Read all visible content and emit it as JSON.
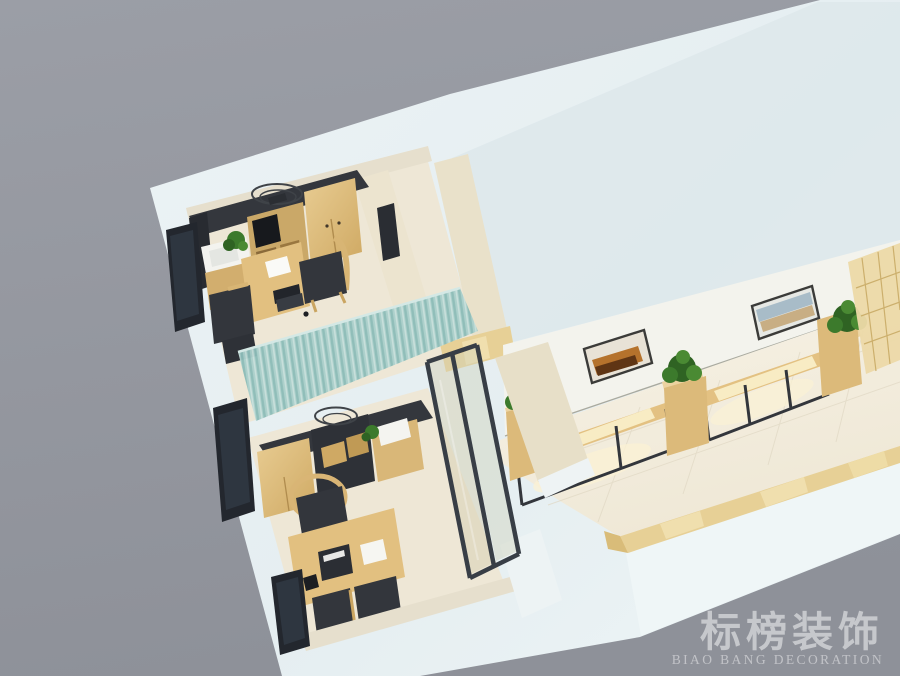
{
  "watermark": {
    "brand_cn": "标榜装饰",
    "brand_en": "BIAO BANG DECORATION"
  },
  "scene": {
    "type": "3d-interior-rendering",
    "view": "axonometric-dollhouse-cutaway",
    "background_color": "#989ba3",
    "palette": {
      "outer_wall": "#e9f1f3",
      "outer_wall_shade": "#dde8eb",
      "interior_wall_cream": "#e9e1ca",
      "office_floor": "#efe8d8",
      "hallway_floor": "#f4efe2",
      "wood": "#ddbb7b",
      "wood_light": "#ecd3a0",
      "dark_cabinet": "#34373d",
      "window_dark": "#23272e",
      "curtain_teal": "#a7cdc9",
      "glass_frame": "#3a4048",
      "tile_border_tan": "#e7d096",
      "plant_green": "#2f6323",
      "bench_glow": "#f8ecc4",
      "watermark_text": "#ced3da"
    },
    "rooms": [
      {
        "name": "office-1",
        "furniture": [
          "ceiling-fan",
          "dark-storage-counter",
          "tv-shelf-unit",
          "wood-wardrobe",
          "wash-basin-cabinet",
          "potted-plant",
          "work-desk",
          "paper-sheet",
          "laptop",
          "office-chair",
          "guest-seat",
          "guest-seat-2"
        ]
      },
      {
        "name": "office-2",
        "furniture": [
          "ceiling-lamp",
          "dark-storage-counter",
          "cubby-shelf",
          "wood-cabinet",
          "towel-cabinet",
          "potted-plant",
          "round-back-chair",
          "work-desk",
          "printer-box",
          "white-book",
          "phone",
          "guest-seat",
          "guest-seat-2"
        ]
      },
      {
        "name": "display-hallway",
        "furniture": [
          "wall-art-1",
          "wall-art-2",
          "display-bench-1",
          "display-bench-2",
          "planter-left",
          "planter-middle",
          "planter-right",
          "lattice-screen",
          "end-cabinet"
        ]
      }
    ],
    "dividers": [
      "teal-pleated-curtain",
      "glass-partition"
    ],
    "window_count": 3,
    "painting_count": 2,
    "bench_count": 2,
    "planter_count": 3
  }
}
